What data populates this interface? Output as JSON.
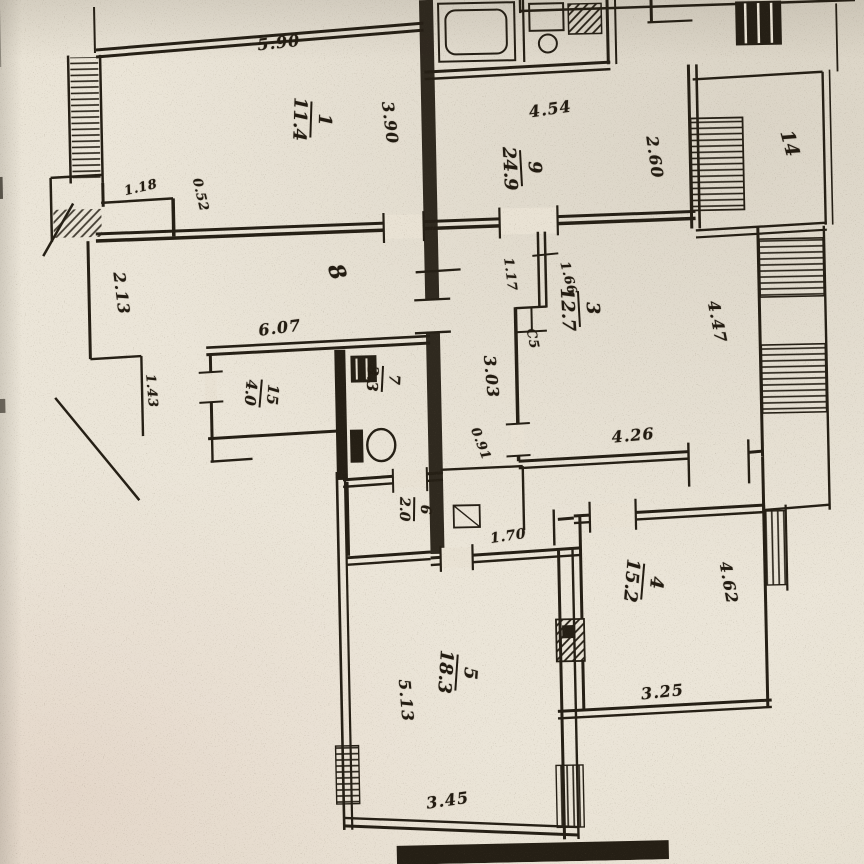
{
  "document": {
    "kind": "scanned apartment floor plan (BTI technical passport style)",
    "paper_color": "#e9e2d4",
    "ink_color": "#251f15"
  },
  "rooms": {
    "r1": {
      "number": "1",
      "area": "11.4"
    },
    "r9": {
      "number": "9",
      "area": "24.9"
    },
    "r3": {
      "number": "3",
      "area": "12.7"
    },
    "r4": {
      "number": "4",
      "area": "15.2"
    },
    "r5": {
      "number": "5",
      "area": "18.3"
    },
    "r15": {
      "number": "15",
      "area": "4.0"
    },
    "r7": {
      "number": "7",
      "area": "3.3"
    },
    "r6": {
      "number": "6",
      "area": "2.0"
    }
  },
  "zones": {
    "corridor": {
      "label": "8"
    },
    "loggia": {
      "label": "14"
    }
  },
  "dimensions": {
    "d590": {
      "text": "5.90"
    },
    "d390": {
      "text": "3.90"
    },
    "d454": {
      "text": "4.54"
    },
    "d260": {
      "text": "2.60"
    },
    "d118": {
      "text": "1.18"
    },
    "d052": {
      "text": "0.52"
    },
    "d213": {
      "text": "2.13"
    },
    "d607": {
      "text": "6.07"
    },
    "d143": {
      "text": "1.43"
    },
    "d303": {
      "text": "3.03"
    },
    "d091": {
      "text": "0.91"
    },
    "d117": {
      "text": "1.17"
    },
    "d166": {
      "text": "1.66"
    },
    "d447": {
      "text": "4.47"
    },
    "d426": {
      "text": "4.26"
    },
    "d170": {
      "text": "1.70"
    },
    "d462": {
      "text": "4.62"
    },
    "d325": {
      "text": "3.25"
    },
    "d513": {
      "text": "5.13"
    },
    "d345": {
      "text": "3.45"
    }
  },
  "marks": {
    "unclear": {
      "text": "С5"
    }
  }
}
